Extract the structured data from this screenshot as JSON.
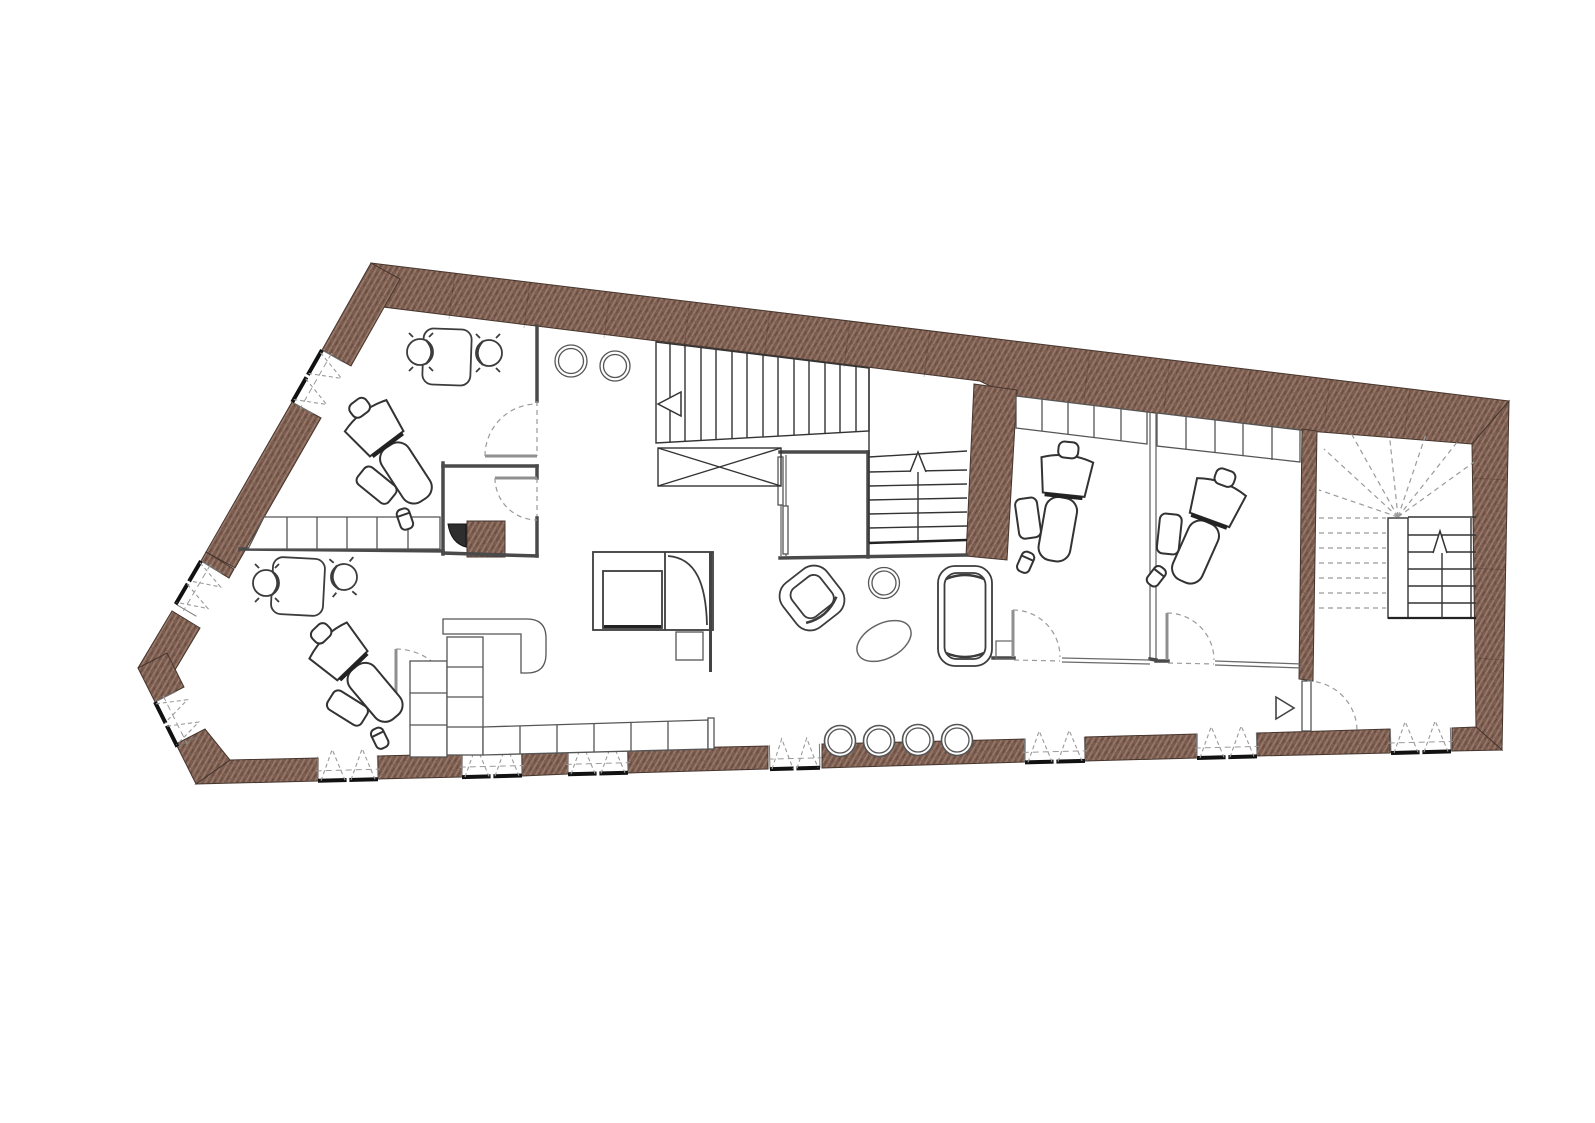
{
  "document": {
    "kind": "architectural-floor-plan",
    "content": "single-storey plan of a dental practice, no text labels visible",
    "orientation": "irregular elongated polygon, wide at right, tapering to a point at left"
  },
  "colors": {
    "bg": "#ffffff",
    "wall-fill": "#7b5c50",
    "wall-hatch-light": "#9b7c6a",
    "wall-hatch-dark": "#5e4539",
    "wall-edge": "#46362e",
    "ink": "#3c3c3c",
    "dash": "#9a9a9a"
  },
  "inventory": {
    "exterior_walls": "thick hatched masonry, continuous on top and right, window openings on bottom and left edges",
    "windows": 10,
    "window_symbol": "black sill bar with paired dashed casement triangles opening inward",
    "doors": 8,
    "stairs": [
      "main straight flight with left direction arrow and crossed void box",
      "secondary flight with up arrow between closet and masonry pier",
      "winder stair with newel, solid treads, up arrow and dashed fan in right stair room"
    ],
    "rooms": [
      "north-west office with desk, two task chairs and dental chair",
      "south-west operatory with desk, two task chairs and dental chair",
      "wc with hatched duct and sink",
      "central hall with two round tables, reception counter and base cabinets",
      "waiting lounge with play booth, square table, armchair, round table, oval rug, sofa and four round stools",
      "treatment room 1 with dental chair and wall cabinets",
      "treatment room 2 with dental chair and wall cabinets",
      "right stair room with entrance door and direction triangle"
    ],
    "dental_chairs": 4,
    "task_chairs": 4,
    "round_stools": 5
  }
}
